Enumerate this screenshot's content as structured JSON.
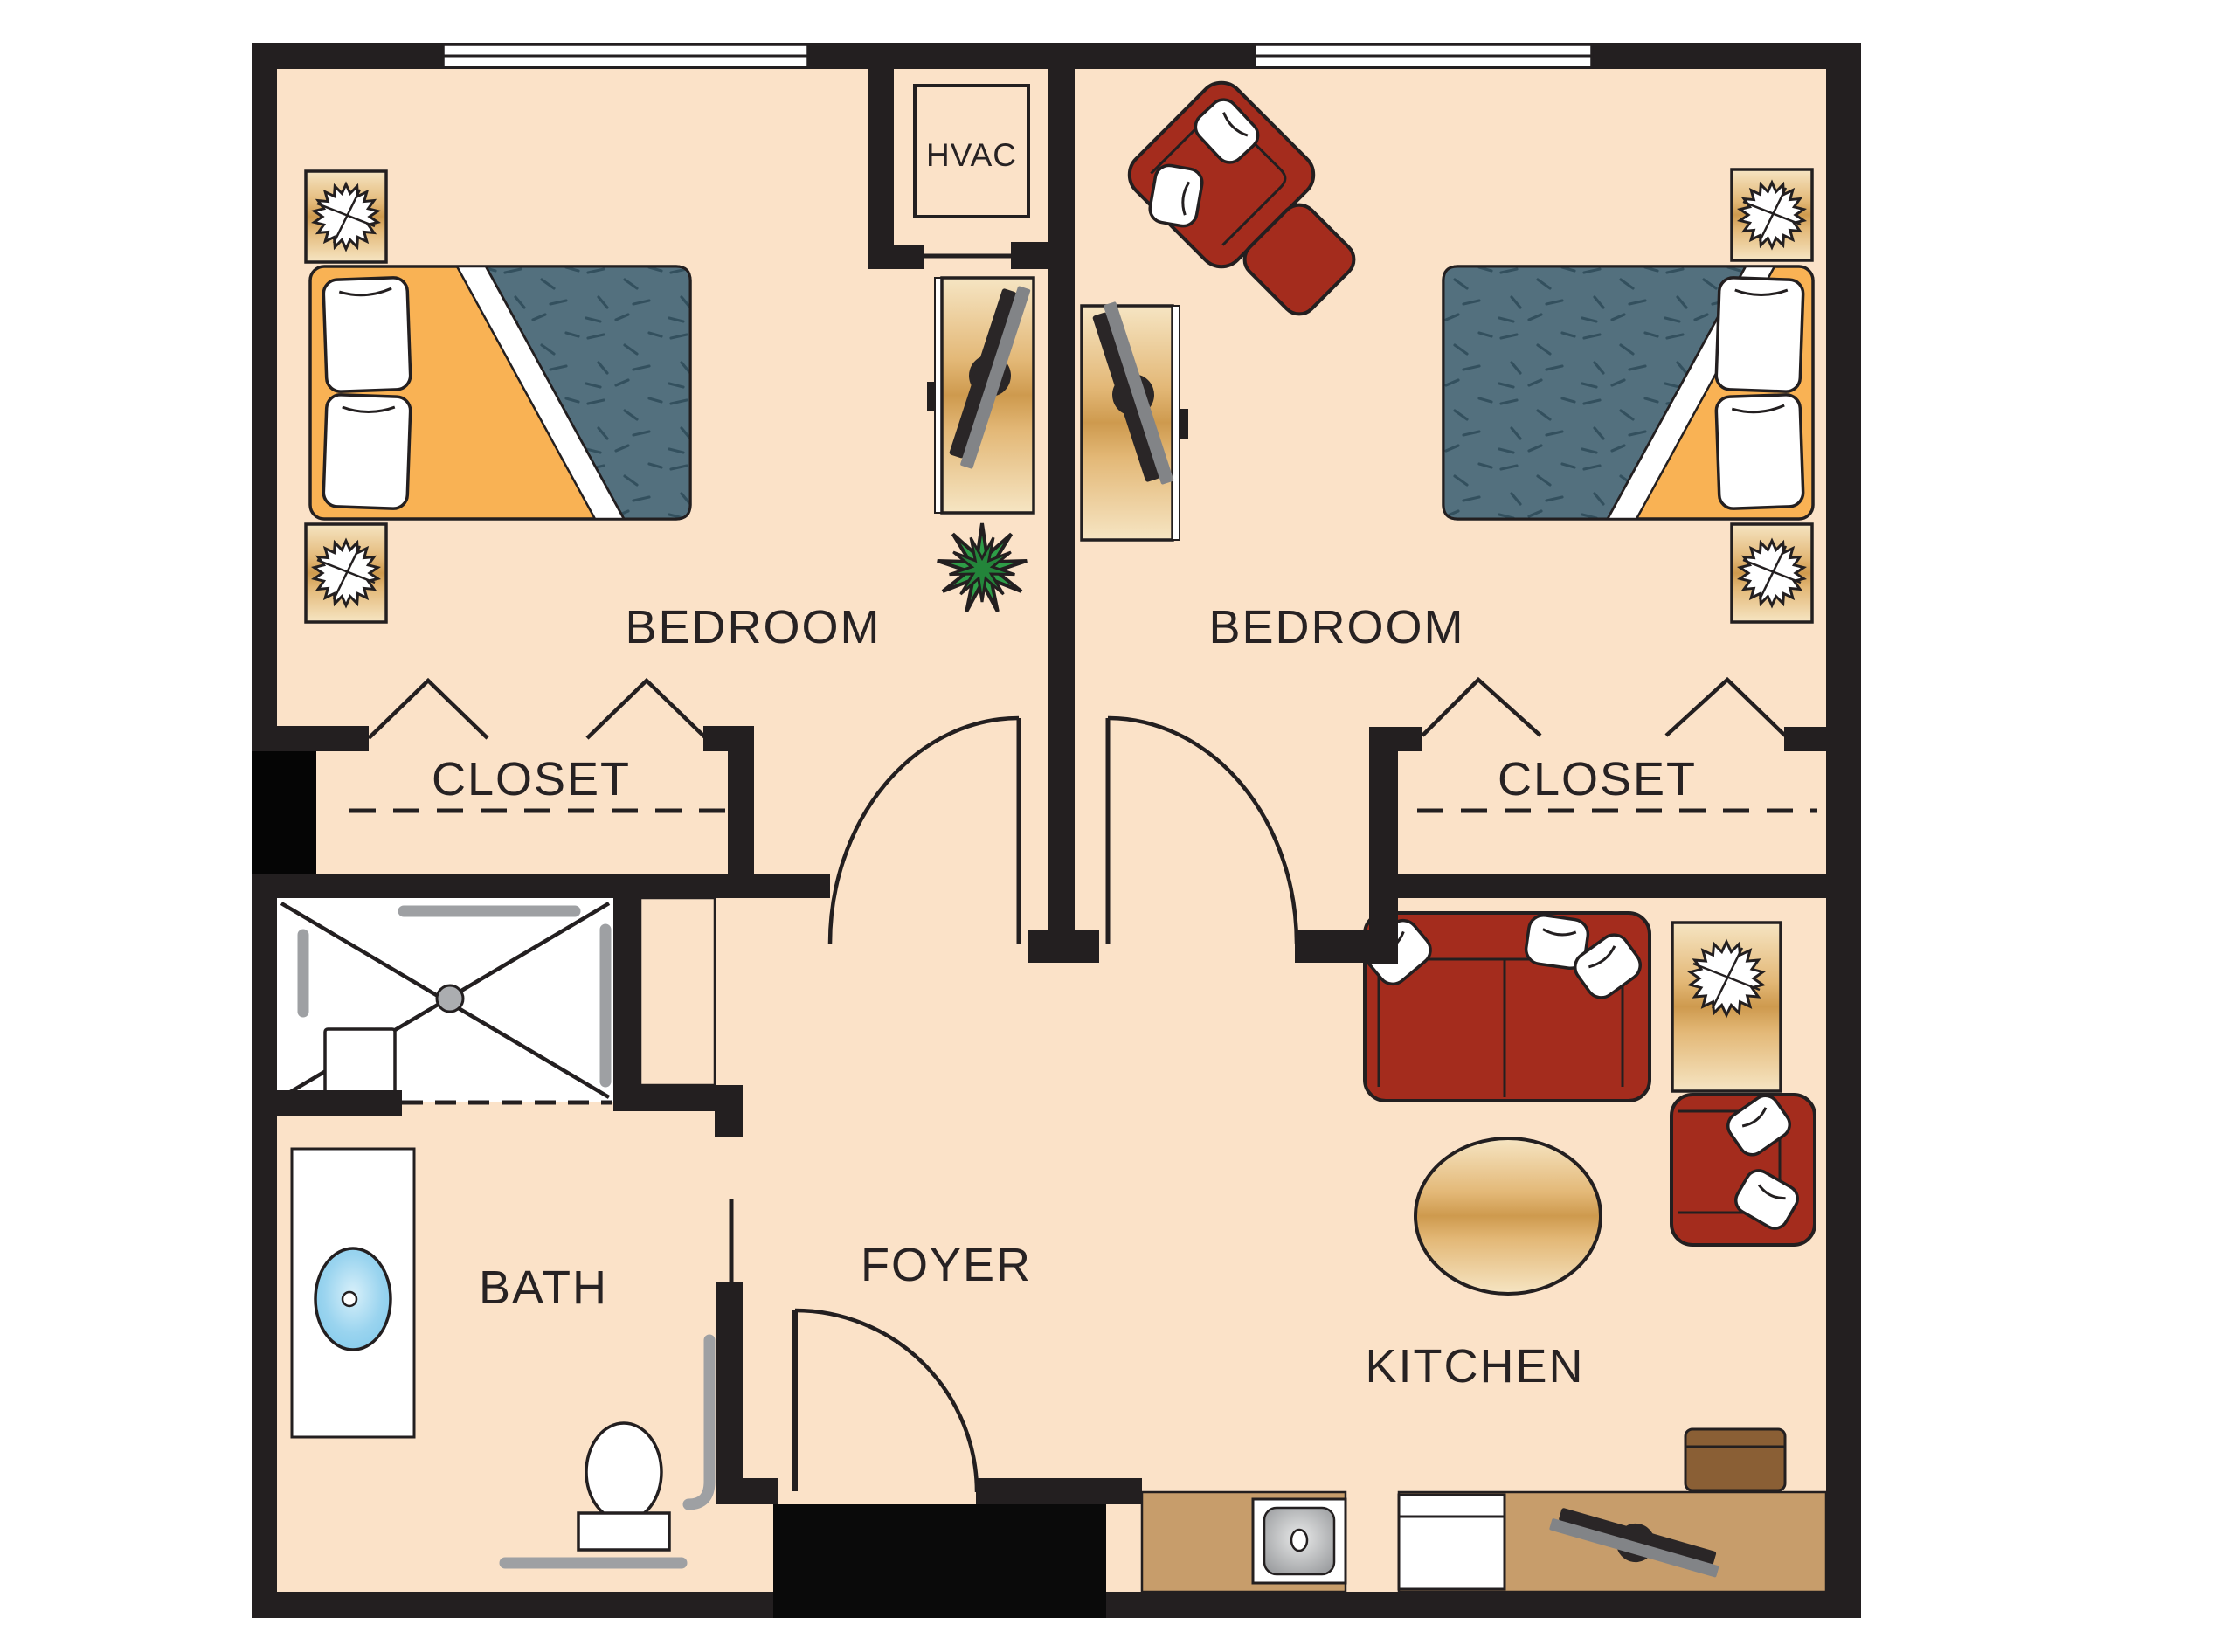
{
  "title": "Two bedroom residential floor plan",
  "rooms": {
    "bedroom_left": {
      "label": "BEDROOM"
    },
    "bedroom_right": {
      "label": "BEDROOM"
    },
    "closet_left": {
      "label": "CLOSET"
    },
    "closet_right": {
      "label": "CLOSET"
    },
    "bath": {
      "label": "BATH"
    },
    "foyer": {
      "label": "FOYER"
    },
    "kitchen": {
      "label": "KITCHEN"
    },
    "hvac": {
      "label": "HVAC"
    }
  },
  "palette": {
    "wall": "#231F20",
    "floor": "#FBE2C8",
    "mattress_blue": "#53707E",
    "headboard_orange": "#F9B254",
    "furniture_red": "#A42C1D",
    "wood_tan_light": "#F6E5C3",
    "wood_tan_gold": "#CE9A4E",
    "counter_tan": "#C79D6B",
    "box_brown": "#8A5F35",
    "sink_blue": "#7EC8EA",
    "grab_bar_gray": "#9EA0A3",
    "plant_green": "#2E9D47",
    "tv_gray": "#828487"
  },
  "furniture_legend": [
    "bed",
    "pillow",
    "nightstand-starburst-plant",
    "tv-on-stand",
    "agave-plant",
    "accent-chair",
    "ottoman",
    "loveseat-sofa",
    "armchair",
    "side-table",
    "oval-dining-table",
    "roll-in-shower",
    "shower-seat",
    "grab-bar",
    "vanity-sink",
    "toilet",
    "kitchen-sink",
    "dishwasher",
    "countertop",
    "storage-box",
    "entry-door",
    "bedroom-door",
    "bifold-closet-doors",
    "window",
    "hvac-unit",
    "entry-vestibule"
  ]
}
